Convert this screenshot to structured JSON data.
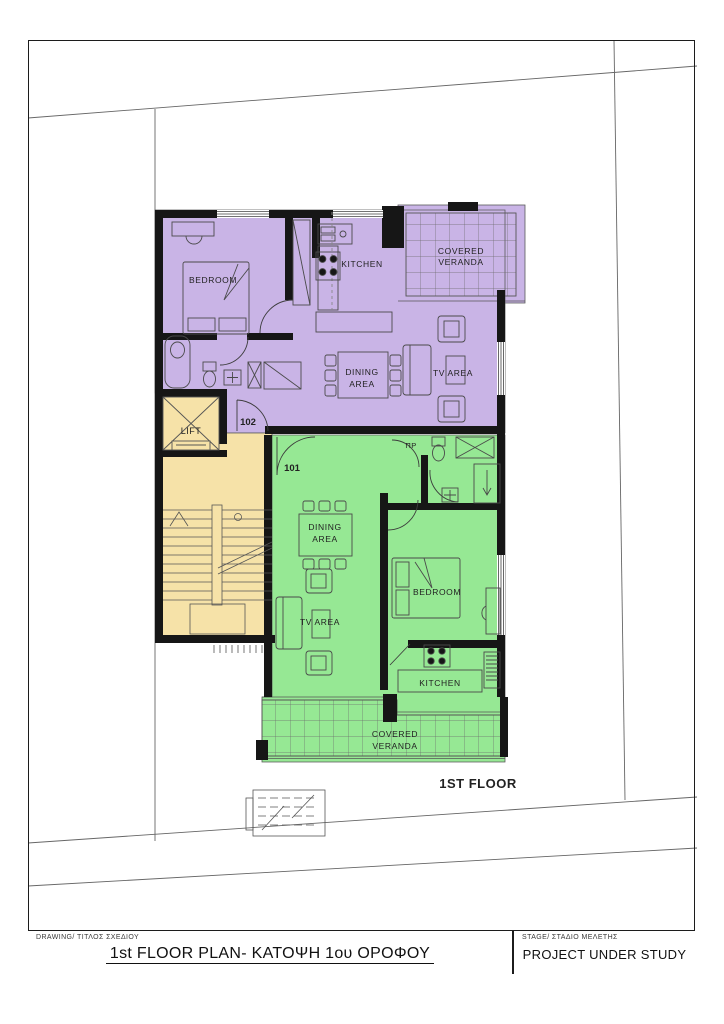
{
  "title_block": {
    "drawing_label": "DRAWING/ ΤΙΤΛΟΣ ΣΧΕΔΙΟΥ",
    "drawing_title": "1st FLOOR PLAN- ΚΑΤΟΨΗ 1ου ΟΡΟΦΟΥ",
    "stage_label": "STAGE/ ΣΤΑΔΙΟ ΜΕΛΕΤΗΣ",
    "stage_value": "PROJECT UNDER STUDY"
  },
  "plan": {
    "floor_label": "1ST FLOOR",
    "unit_102": {
      "number": "102",
      "bedroom_label": "BEDROOM",
      "kitchen_label": "KITCHEN",
      "veranda_label_line1": "COVERED",
      "veranda_label_line2": "VERANDA",
      "dining_label_line1": "DINING",
      "dining_label_line2": "AREA",
      "tv_label": "TV AREA"
    },
    "unit_101": {
      "number": "101",
      "bedroom_label": "BEDROOM",
      "kitchen_label": "KITCHEN",
      "veranda_label_line1": "COVERED",
      "veranda_label_line2": "VERANDA",
      "dining_label_line1": "DINING",
      "dining_label_line2": "AREA",
      "tv_label": "TV AREA",
      "store_label": "ΠΡ"
    },
    "core": {
      "lift_label": "LIFT"
    }
  },
  "colors": {
    "unit_102_fill": "#c9b4e6",
    "unit_101_fill": "#96e894",
    "core_fill": "#f6e2a8",
    "wall": "#161616"
  }
}
